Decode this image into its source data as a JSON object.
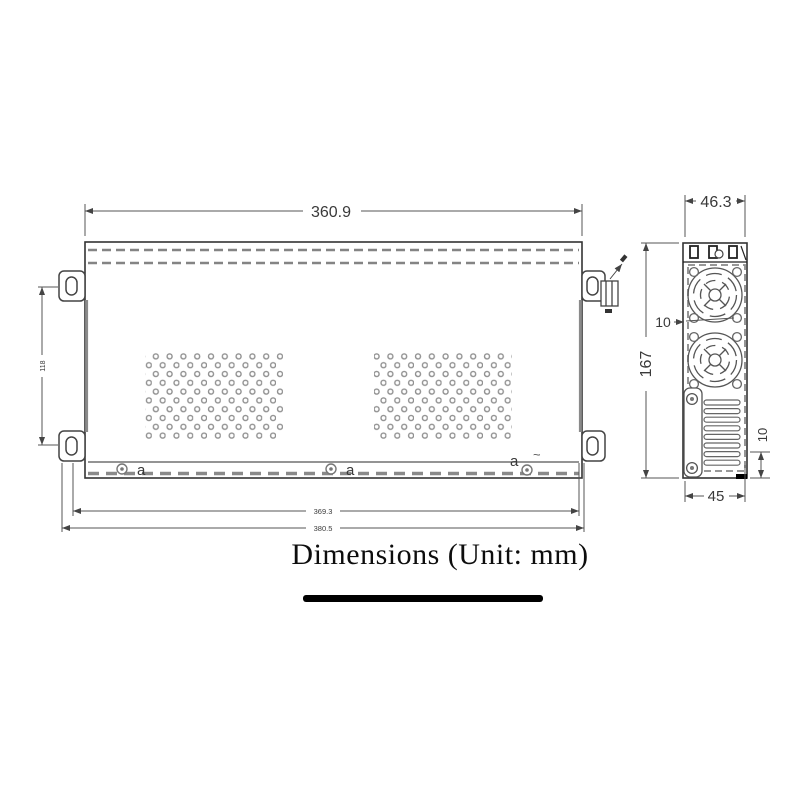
{
  "front": {
    "width_label": "360.9",
    "mount_pitch_label": "118",
    "screw_label": "a",
    "check_mark": "~",
    "inner_width_label": "369.3",
    "outer_width_label": "380.5"
  },
  "side": {
    "depth_label": "46.3",
    "height_label": "167",
    "fan_gap_label": "10",
    "bottom_gap_label": "10",
    "bottom_width_label": "45"
  },
  "caption": {
    "text": "Dimensions (Unit: mm)"
  }
}
